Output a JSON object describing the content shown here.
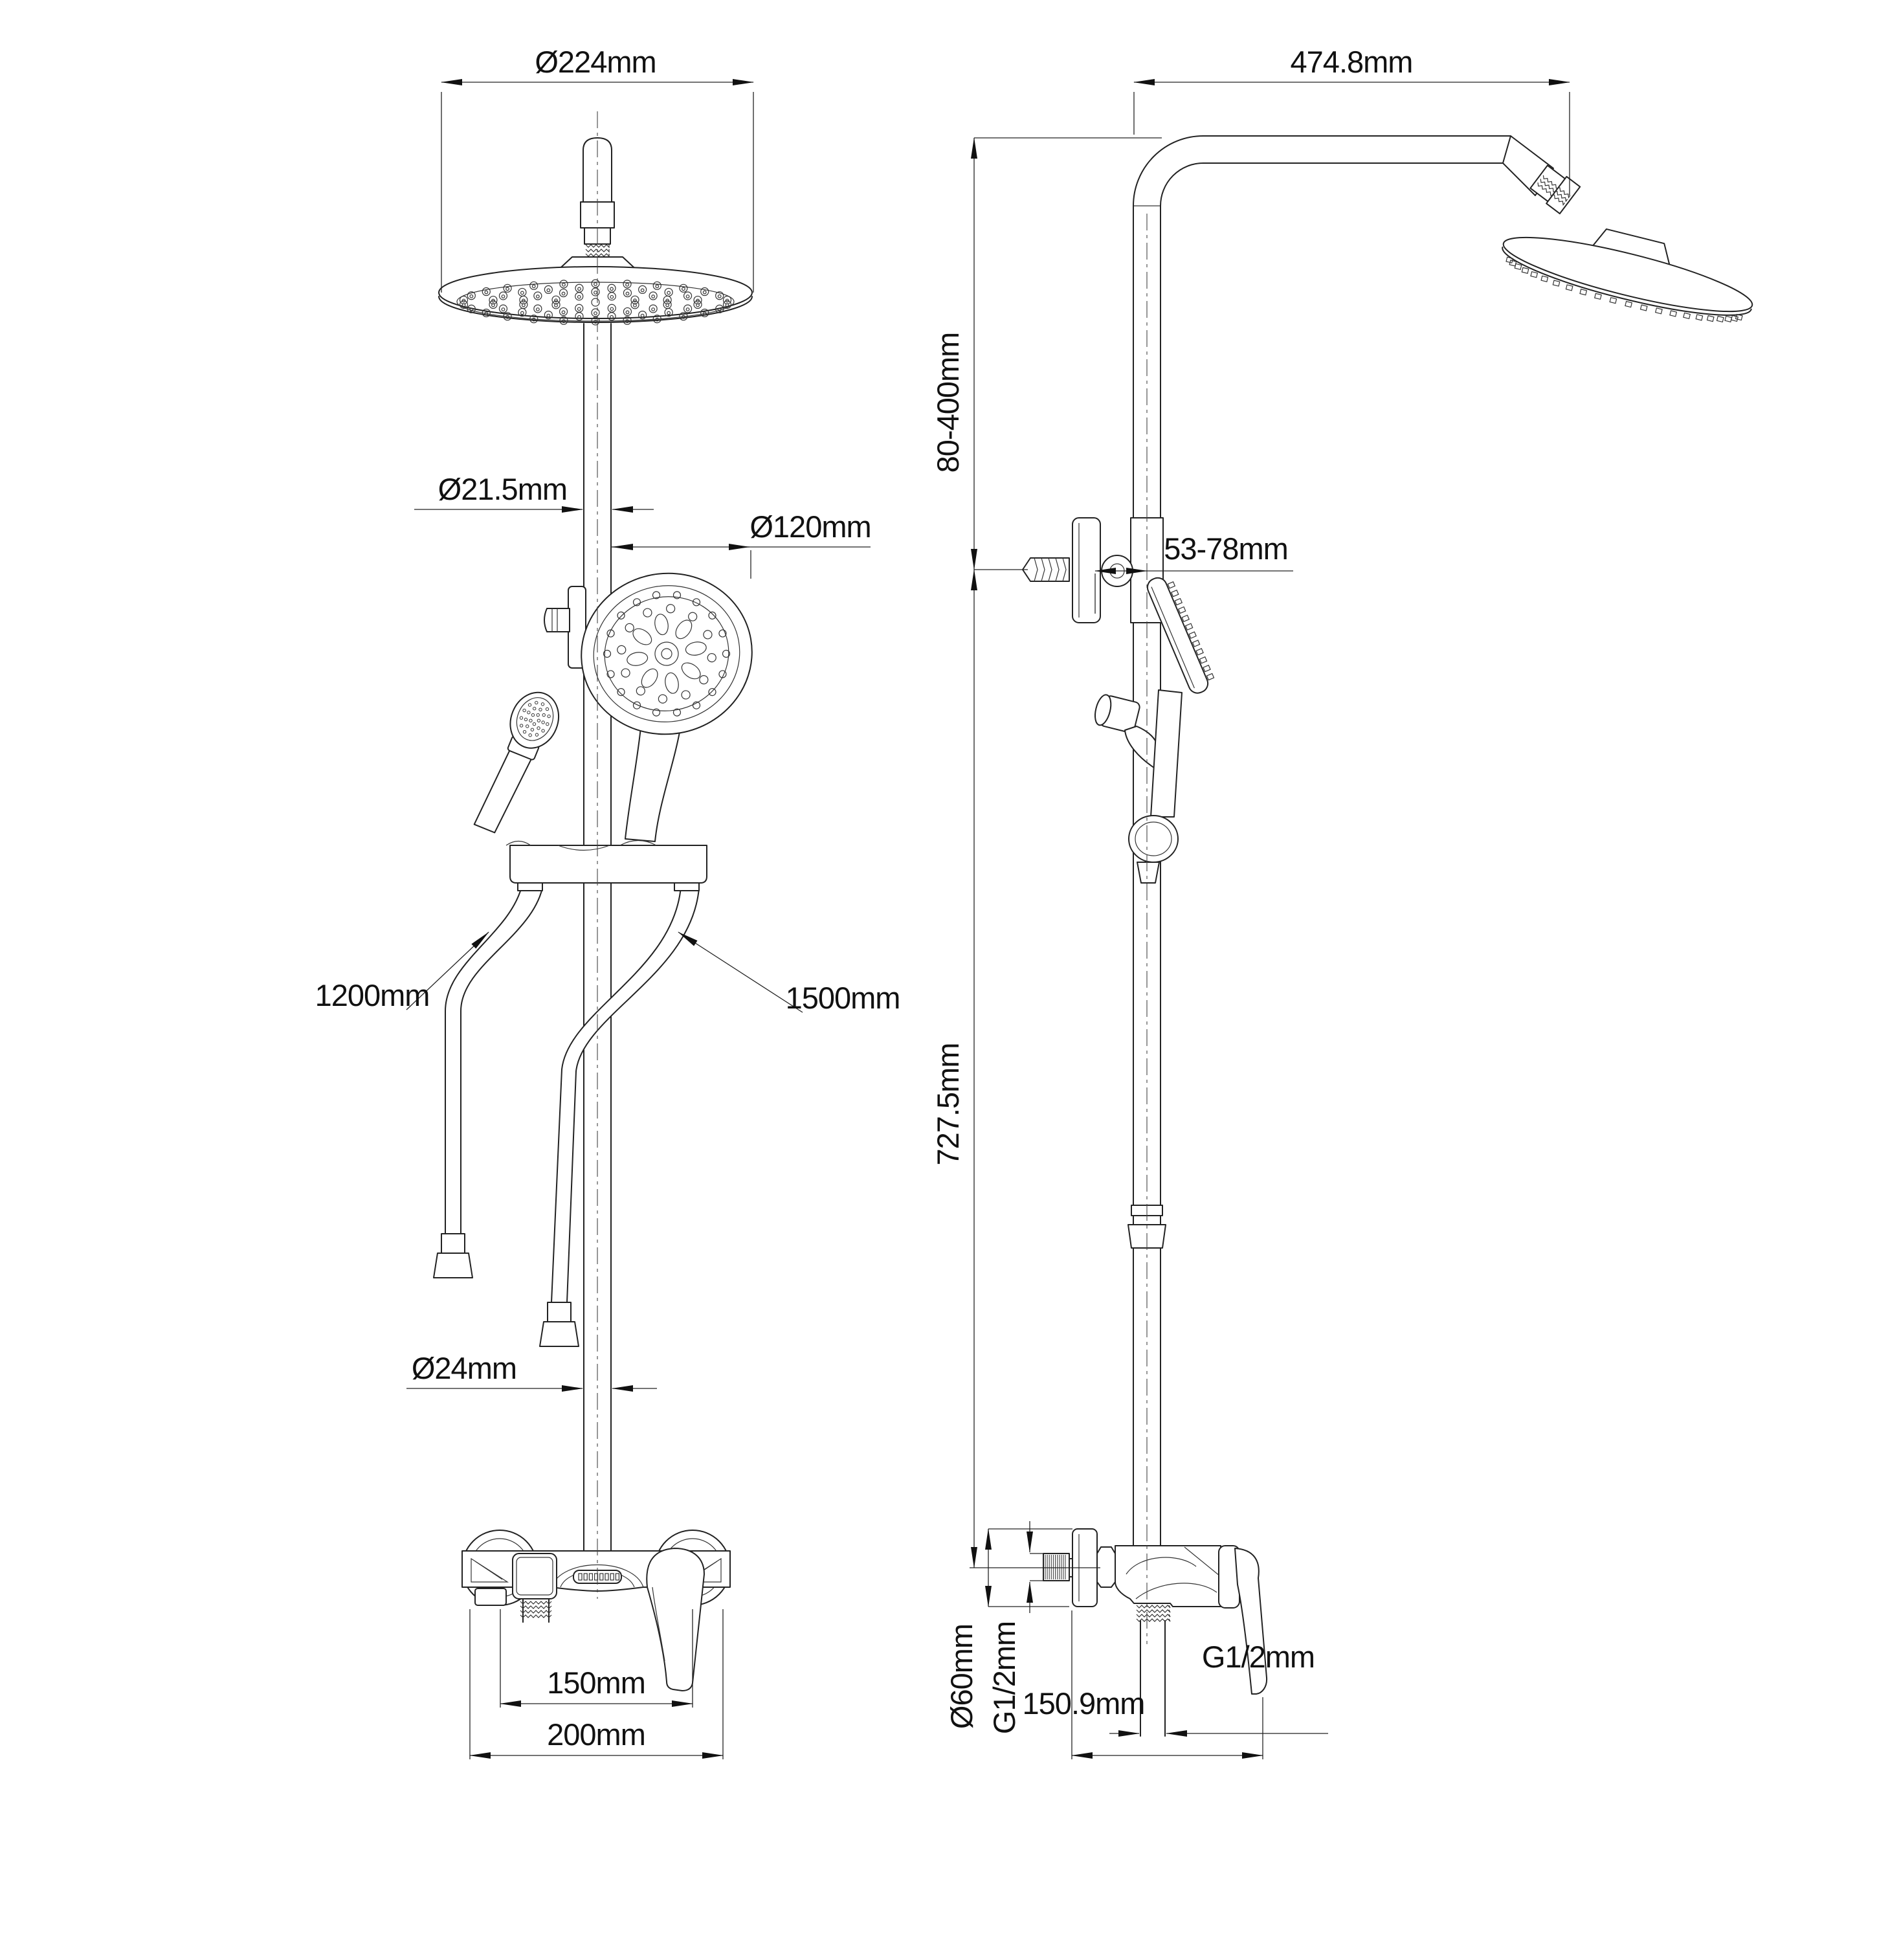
{
  "drawing": {
    "kind": "shower-system-technical-drawing",
    "line_color": "#222222",
    "background": "#ffffff"
  },
  "front_view": {
    "rain_head_diameter": "Ø224mm",
    "riser_pipe_diameter": "Ø21.5mm",
    "hand_shower_diameter": "Ø120mm",
    "left_hose_length": "1200mm",
    "right_hose_length": "1500mm",
    "lower_pipe_diameter": "Ø24mm",
    "valve_center_distance": "150mm",
    "valve_overall_width": "200mm"
  },
  "side_view": {
    "arm_reach": "474.8mm",
    "bracket_height_range": "80-400mm",
    "wall_clearance_range": "53-78mm",
    "riser_length": "727.5mm",
    "flange_diameter": "Ø60mm",
    "inlet_thread": "G1/2mm",
    "outlet_thread": "G1/2mm",
    "valve_depth": "150.9mm"
  }
}
